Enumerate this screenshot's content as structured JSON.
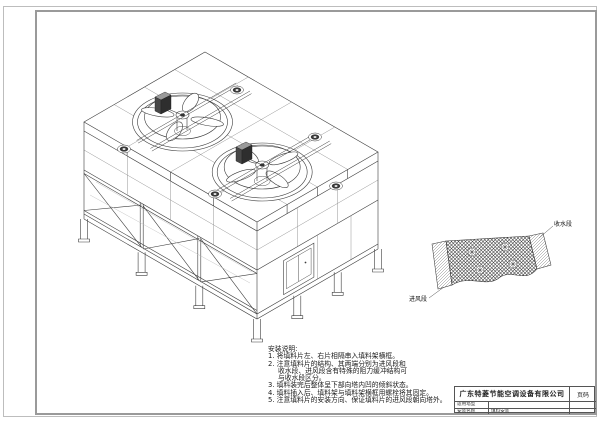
{
  "sheet": {
    "company": "广东特菱节能空调设备有限公司",
    "page_label": "页码",
    "fields": [
      {
        "label": "适用塔型",
        "value": ""
      },
      {
        "label": "安装名称",
        "value": "填料安装"
      }
    ]
  },
  "notes": {
    "title": "安装说明:",
    "lines": [
      "1. 将填料片左、右片相隔串入填料架横框。",
      "2. 注意填料片的结构、其两端分别为进风段和",
      "收水段、进风段含有特殊的阻力缓冲结构可",
      "与收水段区分。",
      "3. 填料装完后整体呈下部向塔内凹的倾斜状态。",
      "4. 填料插入后、填料架与填料架横框用螺栓将其固定。",
      "5. 注意填料片的安装方向、保证填料片的进风段朝向塔外。"
    ]
  },
  "detail": {
    "water_label": "收水段",
    "air_label": "进风段"
  },
  "colors": {
    "ink": "#3c3c3c",
    "frame": "#9a9a9a"
  }
}
